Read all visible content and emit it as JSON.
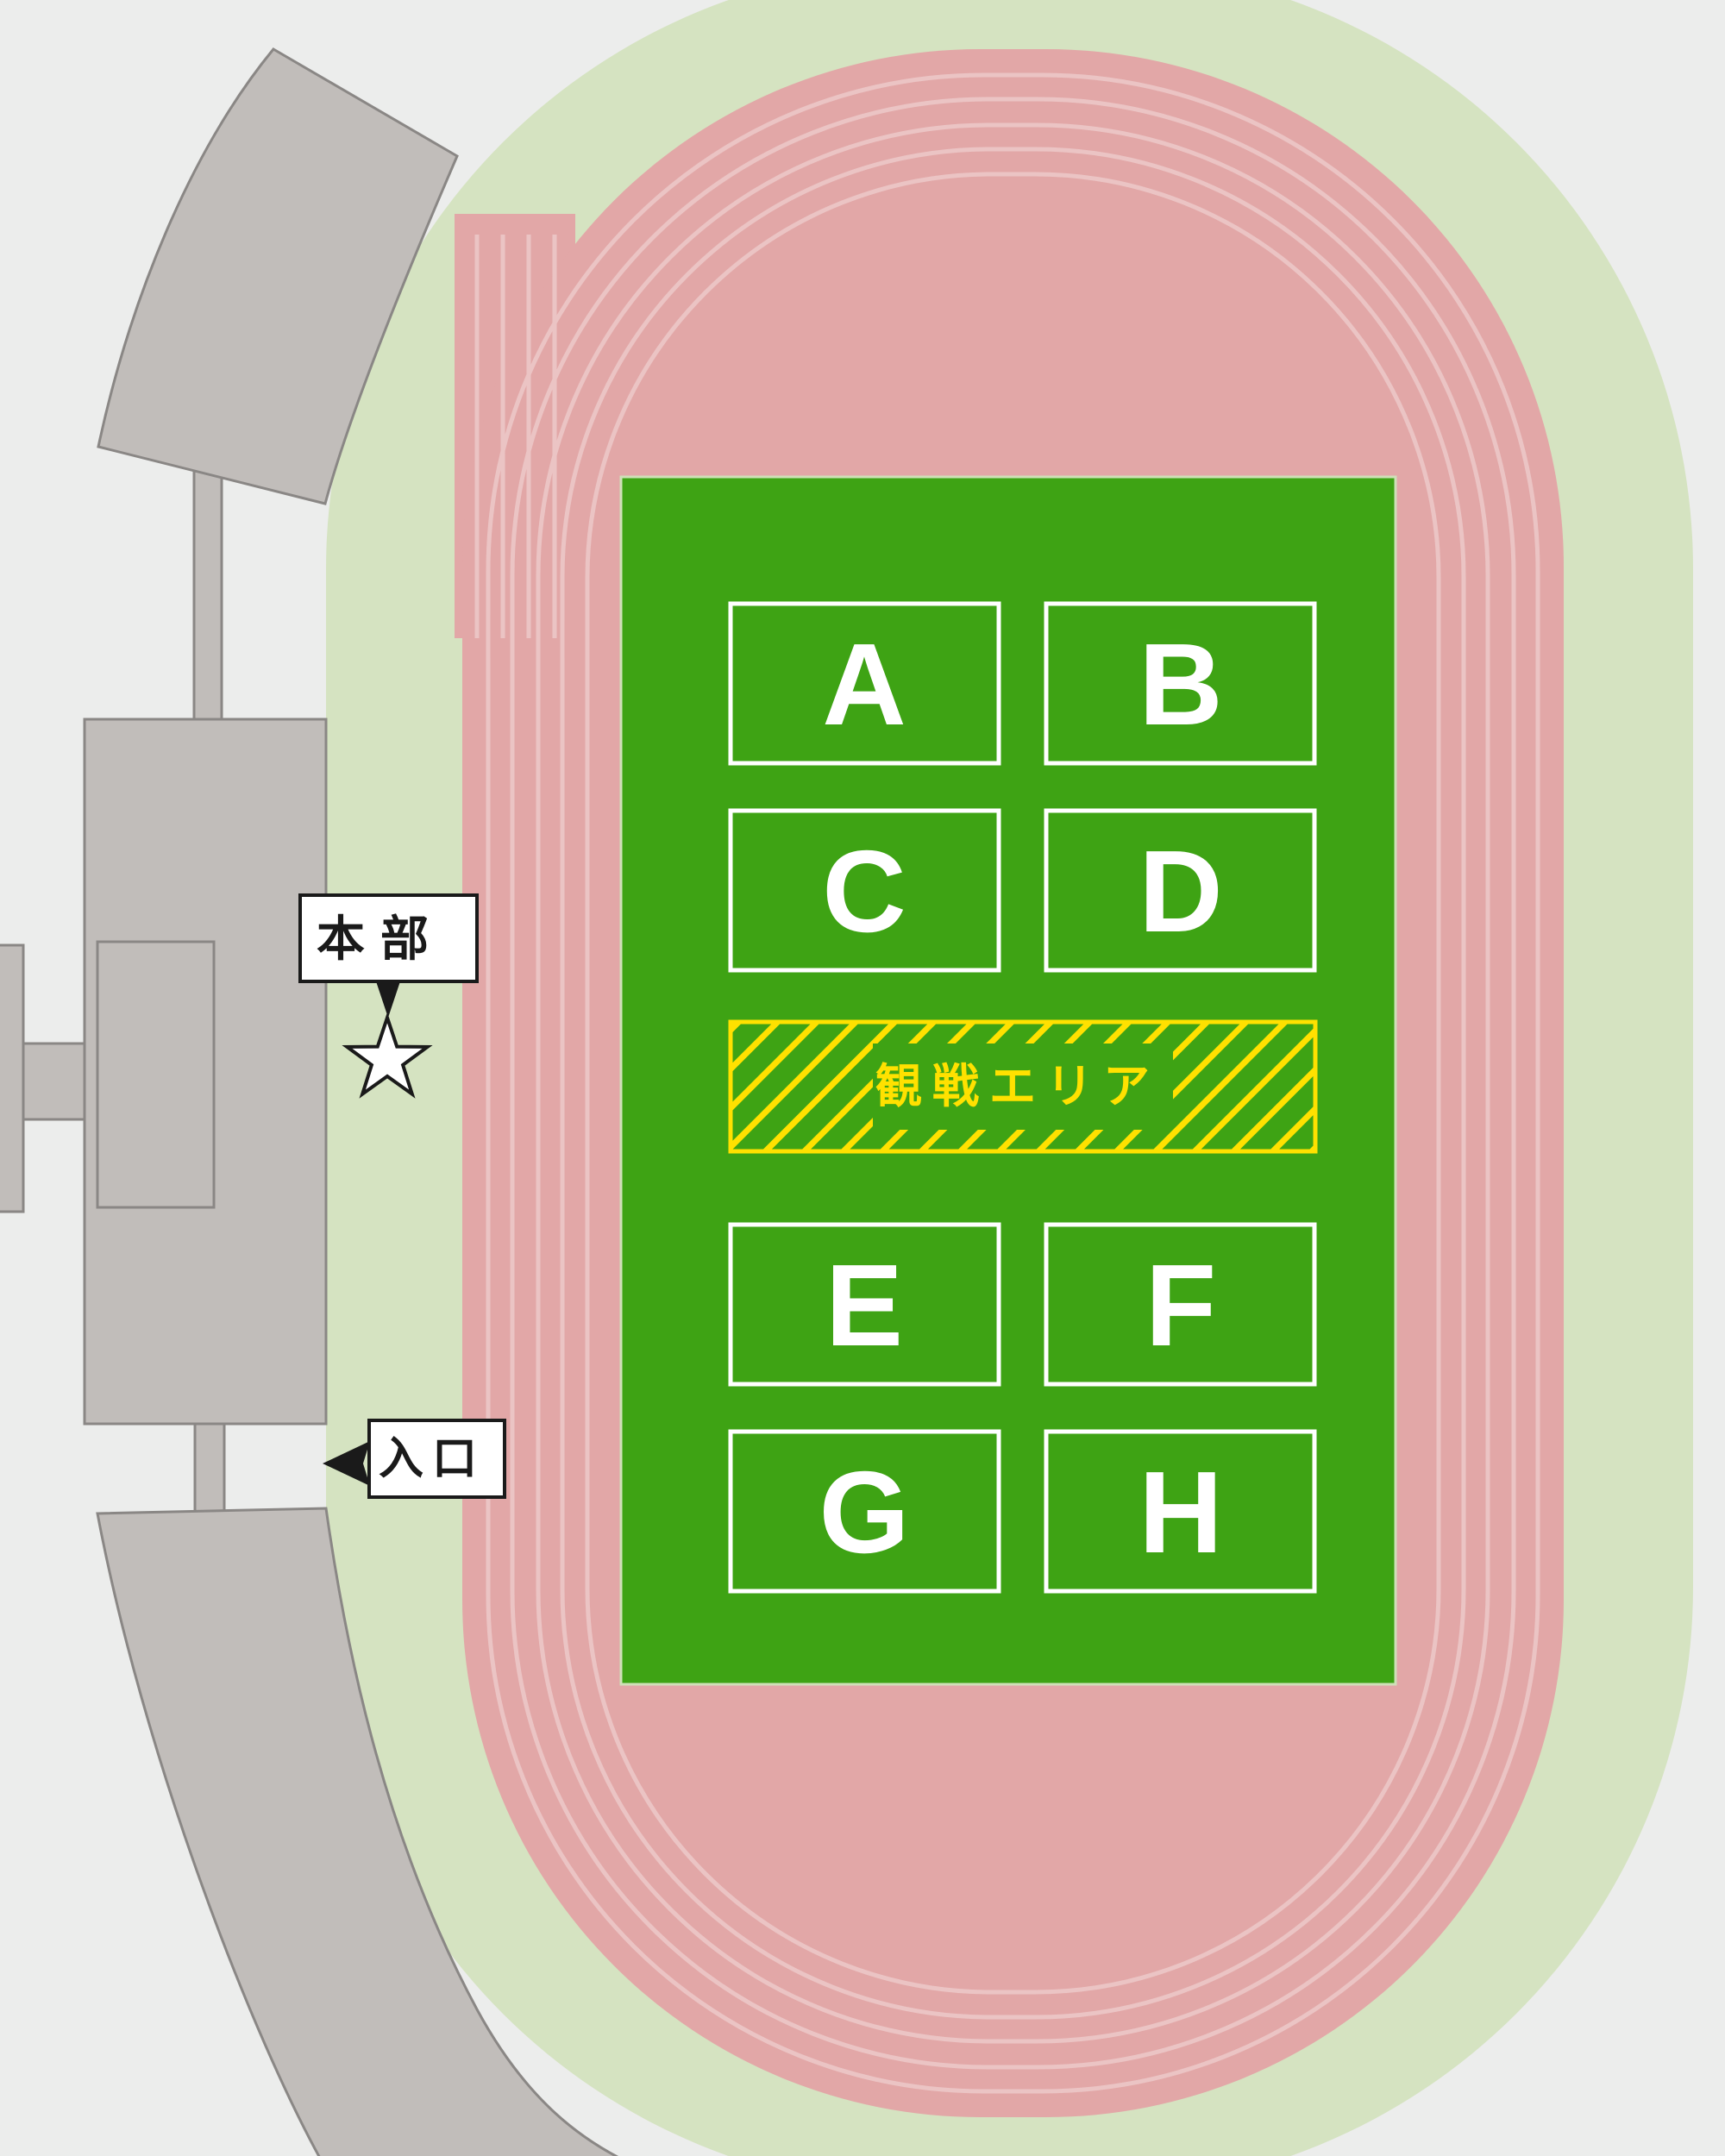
{
  "stadium": {
    "zones": [
      "A",
      "B",
      "C",
      "D",
      "E",
      "F",
      "G",
      "H"
    ],
    "spectator_area_label": "観戦エリア",
    "headquarters_label": "本部",
    "entrance_label": "入口",
    "markers": {
      "headquarters_marker": "star",
      "entrance_marker": "left-arrow"
    },
    "colors": {
      "background_gray": "#ECEDEC",
      "outer_field_green": "#D5E3C1",
      "track_pink": "#E2A7A7",
      "lane_line_pink": "#EBC4C4",
      "infield_green": "#3EA314",
      "accent_yellow": "#FFE100",
      "zone_white": "#FFFFFF",
      "stand_gray": "#C1BDBA",
      "stand_border_gray": "#8A8785",
      "label_black": "#1A1A1A"
    }
  }
}
